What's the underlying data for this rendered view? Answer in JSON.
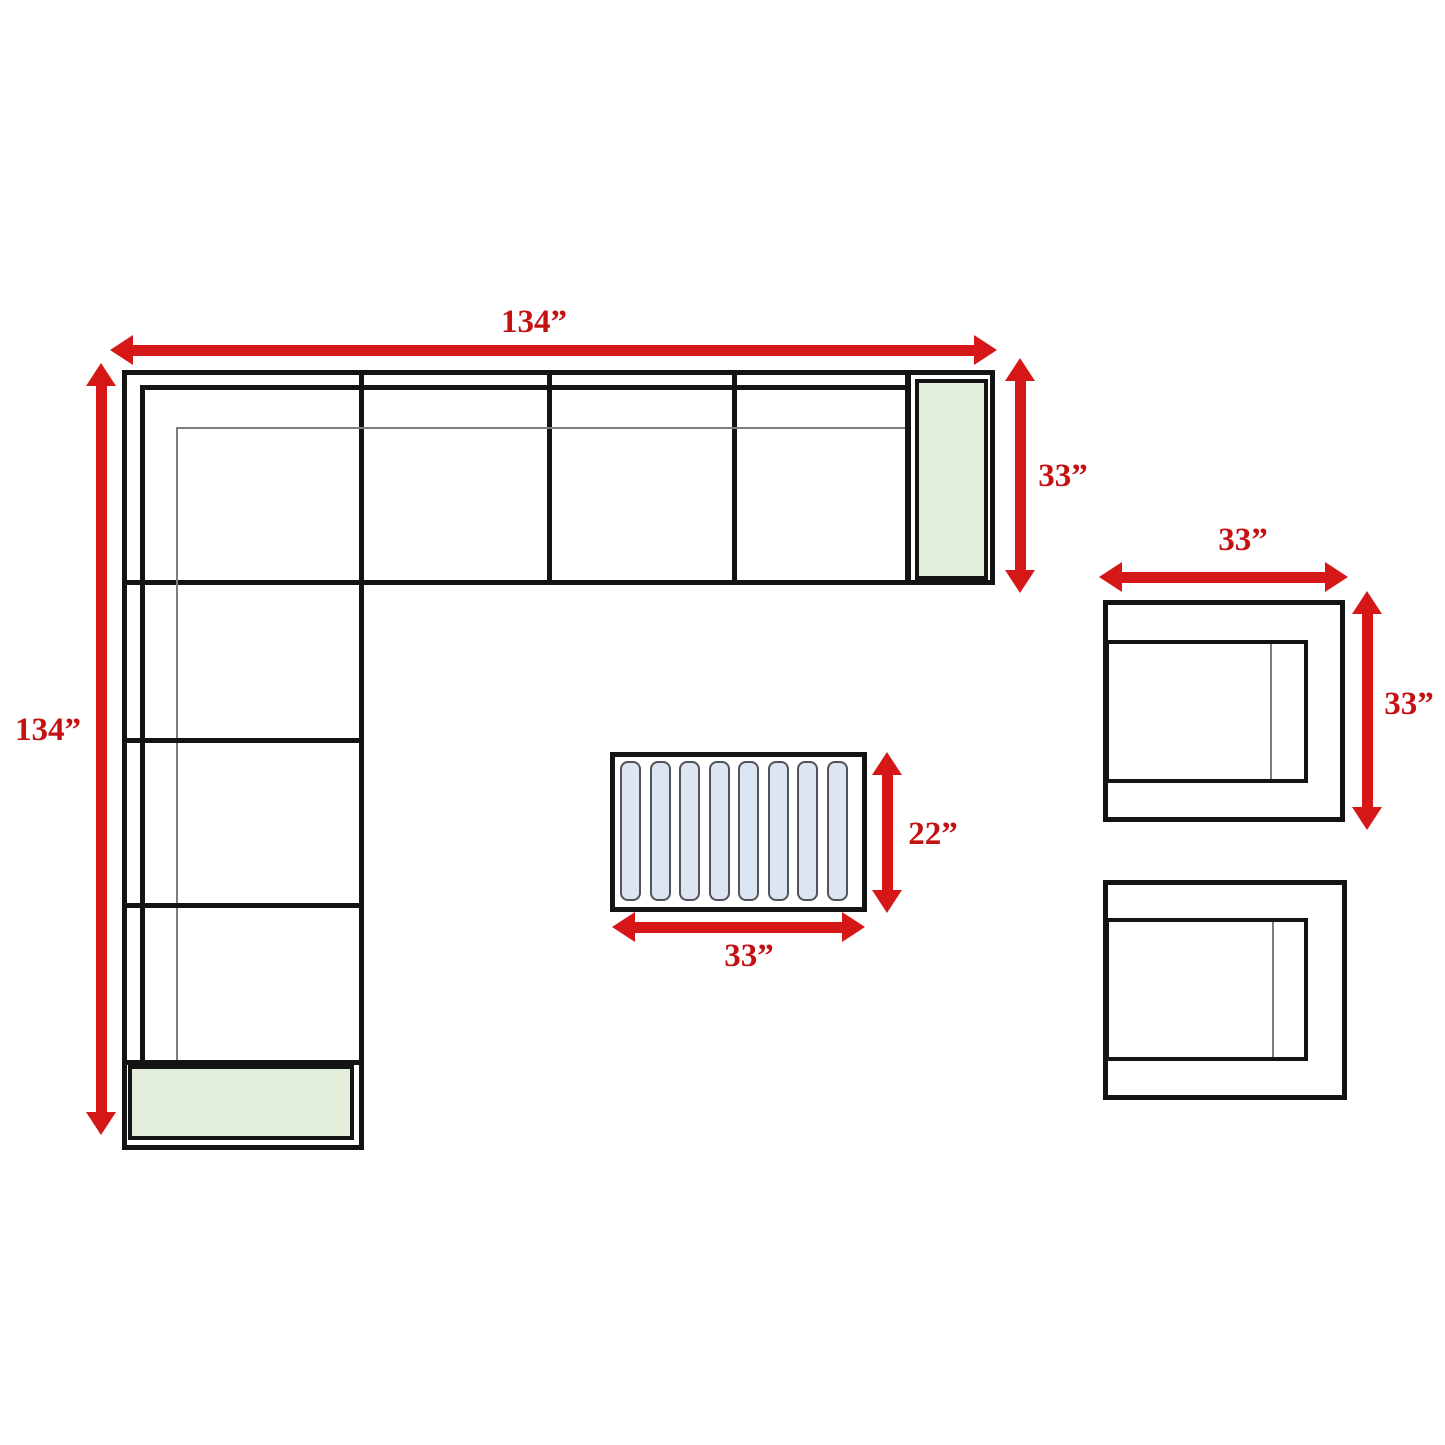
{
  "labels": {
    "sofa_width": "134”",
    "sofa_depth": "134”",
    "end_depth": "33”",
    "chair_width": "33”",
    "chair_depth": "33”",
    "table_width": "33”",
    "table_depth": "22”"
  },
  "coffee_table": {
    "slat_count": 8
  },
  "colors": {
    "arrow_red": "#d51717",
    "label_red": "#c41111",
    "line_black": "#141414",
    "thin_gray": "#7d7d7d",
    "cushion_green": "#e3efda",
    "slat_blue": "#dde4f2",
    "slat_border": "#52525a",
    "background": "#ffffff"
  }
}
